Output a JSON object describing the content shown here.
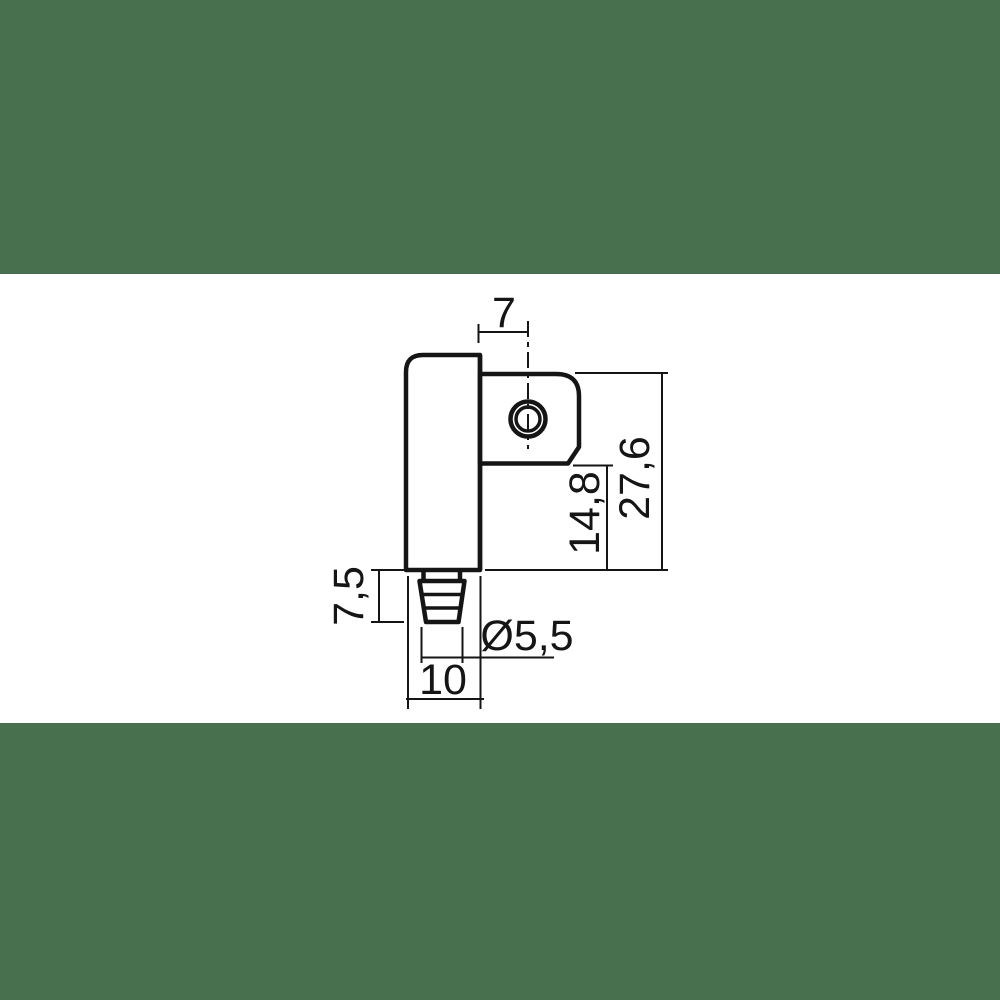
{
  "scene": {
    "background_color": "#48704E",
    "canvas_color": "#FFFFFF",
    "line_color": "#151515",
    "description": "dimensioned technical drawing of a clamp body with hose barb"
  },
  "drawing": {
    "labels": {
      "hole_offset": "7",
      "height_total": "27,6",
      "height_lower": "14,8",
      "barb_length": "7,5",
      "barb_diameter": "Ø5,5",
      "body_width": "10"
    }
  }
}
